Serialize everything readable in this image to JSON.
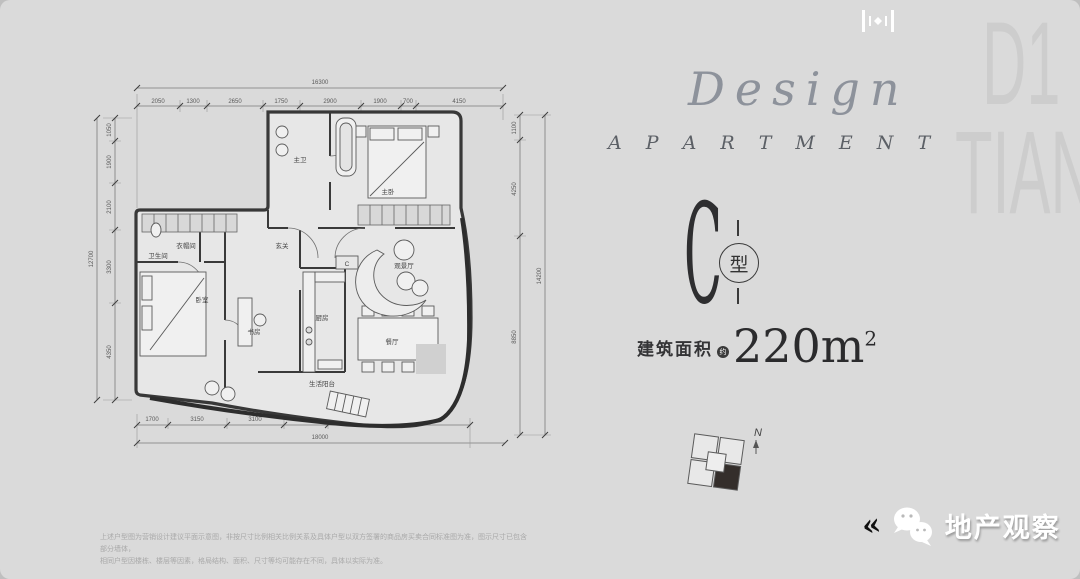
{
  "branding": {
    "design_script": "Design",
    "apartment_caps": "A P A R T M E N T",
    "watermark_line1": "D1",
    "watermark_line2": "TIANF"
  },
  "unit": {
    "letter": "C",
    "type_char": "型",
    "area_label": "建筑面积",
    "area_approx": "约",
    "area_value": "220m",
    "area_sup": "2",
    "plan_marker": "C"
  },
  "locator": {
    "north_label": "N"
  },
  "footer": {
    "chevrons": "«",
    "brand_name": "地产观察",
    "disclaimer_line1": "上述户型图为营销设计建议平面示意图，非按尺寸比例相关比例关系及具体户型以双方签署的商品房买卖合同标准图为准，图示尺寸已包含部分墙体，",
    "disclaimer_line2": "相同户型因楼栋、楼层等因素，格局结构、面积、尺寸等均可能存在不同，具体以实际为准。"
  },
  "plan": {
    "rooms": [
      "主卫",
      "主卧",
      "衣帽间",
      "卫生间",
      "玄关",
      "卧室",
      "书房",
      "厨房",
      "餐厅",
      "观景厅",
      "生活阳台"
    ],
    "dims": {
      "top_total": "16300",
      "top_segments": [
        "2050",
        "1300",
        "2650",
        "1750",
        "2900",
        "1900",
        "700",
        "4150"
      ],
      "left_total": "12700",
      "left_segments": [
        "1050",
        "1900",
        "2100",
        "3300",
        "4350"
      ],
      "right_total": "14200",
      "right_segments": [
        "1100",
        "4250",
        "8850"
      ],
      "bottom_total": "18000",
      "bottom_segments": [
        "1700",
        "3150",
        "3100",
        "2400",
        "7650"
      ]
    }
  },
  "colors": {
    "background": "#dadada",
    "ink": "#3a3a3a",
    "unit_fill": "#342e2b",
    "white": "#ffffff"
  }
}
